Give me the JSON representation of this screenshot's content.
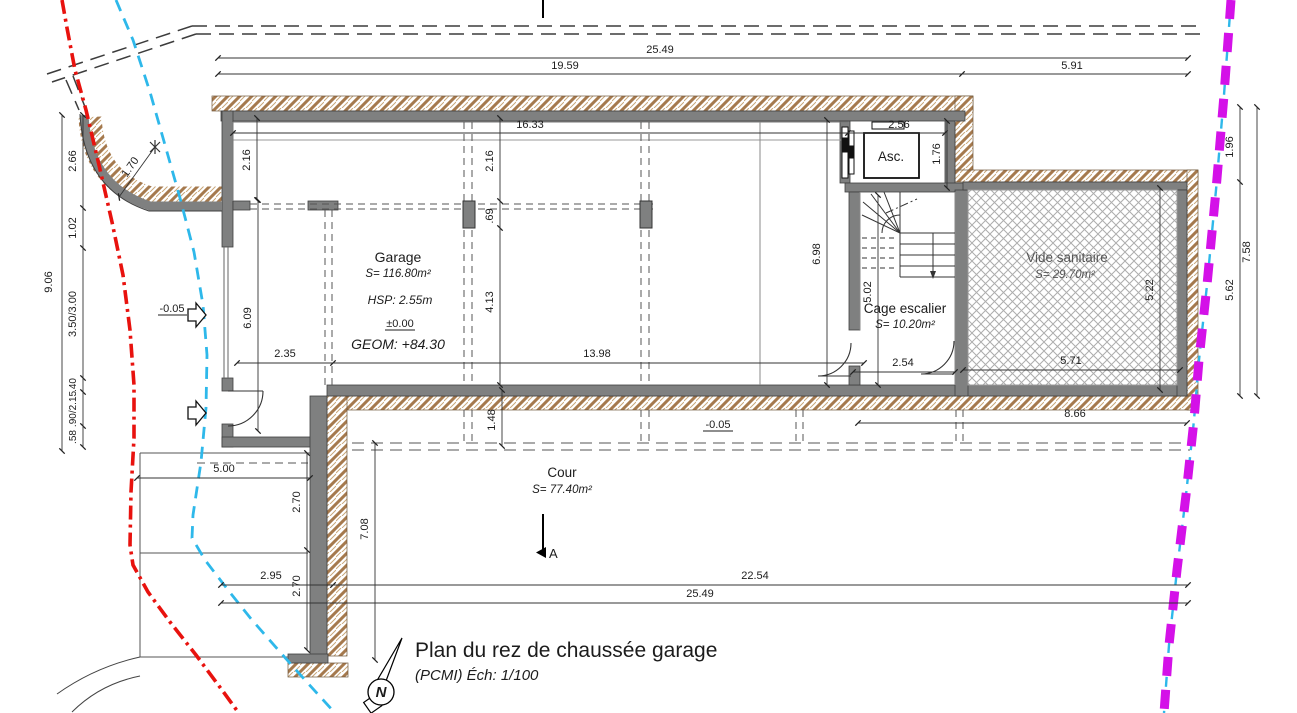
{
  "drawing": {
    "title": "Plan du rez de chaussée garage",
    "subtitle": "(PCMI) Éch: 1/100",
    "north_label": "N",
    "section_label": "A"
  },
  "rooms": {
    "garage": {
      "name": "Garage",
      "area": "S= 116.80m²",
      "hsp": "HSP: 2.55m",
      "level": "±0.00",
      "geom": "GEOM: +84.30"
    },
    "ascenseur": {
      "name": "Asc."
    },
    "cage_escalier": {
      "name": "Cage escalier",
      "area": "S= 10.20m²"
    },
    "vide_sanitaire": {
      "name": "Vide sanitaire",
      "area": "S= 29.70m²"
    },
    "cour": {
      "name": "Cour",
      "area": "S= 77.40m²"
    }
  },
  "levels": {
    "entry": "-0.05",
    "cour": "-0.05"
  },
  "dims": {
    "t25": "25.49",
    "t19": "19.59",
    "t591": "5.91",
    "g1633": "16.33",
    "asc_w": "2.56",
    "asc_h": "1.76",
    "r196": "1.96",
    "r562": "5.62",
    "r758": "7.58",
    "l906": "9.06",
    "l266": "2.66",
    "l102": "1.02",
    "l350": "3.50/3.00",
    "l040": ".40",
    "l090": ".90/2.15",
    "l058": ".58",
    "rad": "1.70",
    "wl216": "2.16",
    "wm216": "2.16",
    "wm069": ".69",
    "wm413": "4.13",
    "wl609": "6.09",
    "r698": "6.98",
    "b235": "2.35",
    "b1398": "13.98",
    "s502": "5.02",
    "s254": "2.54",
    "v522": "5.22",
    "v571": "5.71",
    "c148": "1.48",
    "c866": "8.66",
    "c500": "5.00",
    "c270a": "2.70",
    "c270b": "2.70",
    "c708": "7.08",
    "c295": "2.95",
    "c2254": "22.54",
    "c2549": "25.49"
  },
  "colors": {
    "wall_gray": "#7f8080",
    "hatch_brown": "#a5794d",
    "boundary_red": "#e8120e",
    "network_cyan": "#2eb8ea",
    "limit_magenta": "#d411e8"
  }
}
